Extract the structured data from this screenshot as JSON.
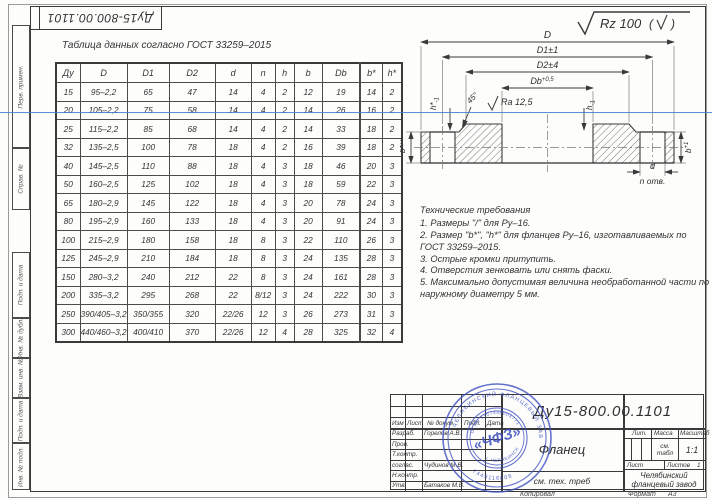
{
  "frame": {
    "margin_labels": [
      "Перв. примен.",
      "Справ. №",
      "Подп. и дата",
      "Инв. № дубл.",
      "Взам. инв. №",
      "Подп. и дата",
      "Инв. № подл."
    ],
    "corner_doc_number": "Ду15-800.00.1101"
  },
  "table": {
    "caption": "Таблица данных согласно ГОСТ  33259–2015",
    "headers": [
      "Ду",
      "D",
      "D1",
      "D2",
      "d",
      "n",
      "h",
      "b",
      "Db",
      "b*",
      "h*"
    ],
    "rows": [
      [
        "15",
        "95–2,2",
        "65",
        "47",
        "14",
        "4",
        "2",
        "12",
        "19",
        "14",
        "2"
      ],
      [
        "20",
        "105–2,2",
        "75",
        "58",
        "14",
        "4",
        "2",
        "14",
        "26",
        "16",
        "2"
      ],
      [
        "25",
        "115–2,2",
        "85",
        "68",
        "14",
        "4",
        "2",
        "14",
        "33",
        "18",
        "2"
      ],
      [
        "32",
        "135–2,5",
        "100",
        "78",
        "18",
        "4",
        "2",
        "16",
        "39",
        "18",
        "2"
      ],
      [
        "40",
        "145–2,5",
        "110",
        "88",
        "18",
        "4",
        "3",
        "18",
        "46",
        "20",
        "3"
      ],
      [
        "50",
        "160–2,5",
        "125",
        "102",
        "18",
        "4",
        "3",
        "18",
        "59",
        "22",
        "3"
      ],
      [
        "65",
        "180–2,9",
        "145",
        "122",
        "18",
        "4",
        "3",
        "20",
        "78",
        "24",
        "3"
      ],
      [
        "80",
        "195–2,9",
        "160",
        "133",
        "18",
        "4",
        "3",
        "20",
        "91",
        "24",
        "3"
      ],
      [
        "100",
        "215–2,9",
        "180",
        "158",
        "18",
        "8",
        "3",
        "22",
        "110",
        "26",
        "3"
      ],
      [
        "125",
        "245–2,9",
        "210",
        "184",
        "18",
        "8",
        "3",
        "24",
        "135",
        "28",
        "3"
      ],
      [
        "150",
        "280–3,2",
        "240",
        "212",
        "22",
        "8",
        "3",
        "24",
        "161",
        "28",
        "3"
      ],
      [
        "200",
        "335–3,2",
        "295",
        "268",
        "22",
        "8/12",
        "3",
        "24",
        "222",
        "30",
        "3"
      ],
      [
        "250",
        "390/405–3,2",
        "350/355",
        "320",
        "22/26",
        "12",
        "3",
        "26",
        "273",
        "31",
        "3"
      ],
      [
        "300",
        "440/460–3,2",
        "400/410",
        "370",
        "22/26",
        "12",
        "4",
        "28",
        "325",
        "32",
        "4"
      ]
    ]
  },
  "drawing": {
    "roughness_general": "Rz 100",
    "dims": {
      "D": "D",
      "D1": "D1±1",
      "D2": "D2±4",
      "Db": "Db",
      "Db_tol": "+0,5",
      "Ra": "Ra 12,5",
      "chamfer": "45°",
      "h_star": "h*",
      "h": "h",
      "b_star": "b*",
      "b": "b",
      "tol_minus1": "-1",
      "tol_plus1": "+1",
      "d_hole": "d",
      "n_holes": "n отв."
    }
  },
  "tech_requirements": {
    "title": "Технические требования",
    "items": [
      "1. Размеры \"/\" для Ру–16.",
      "2. Размер \"b*\", \"h*\" для фланцев Ру–16, изготавливаемых по ГОСТ 33259–2015.",
      "3. Острые кромки притупить.",
      "4. Отверстия зенковать или снять фаски.",
      "5. Максимально допустимая величина необработанной части по наружному диаметру 5 мм."
    ]
  },
  "title_block": {
    "doc_number": "Ду15-800.00.1101",
    "part_name": "Фланец",
    "material": "см. тех. треб",
    "company": "Челябинский фланцевый завод",
    "header_cells": [
      "Изм",
      "Лист",
      "№ докум.",
      "Подп.",
      "Дата"
    ],
    "sign_rows": [
      {
        "role": "Разраб.",
        "name": "Горелов А.В."
      },
      {
        "role": "Пров.",
        "name": ""
      },
      {
        "role": "Т.контр.",
        "name": ""
      },
      {
        "role": "соглас.",
        "name": "Чудинов М.В."
      },
      {
        "role": "Н.контр.",
        "name": ""
      },
      {
        "role": "Утв.",
        "name": "Батаков М.В."
      }
    ],
    "lit_label": "Лит.",
    "mass_label": "Масса",
    "scale_label": "Масштаб",
    "mass_value": "см. табл",
    "scale_value": "1:1",
    "sheet_label": "Лист",
    "sheets_label": "Листов",
    "sheets_value": "1",
    "footer_copy": "Копировал",
    "footer_format": "Формат",
    "footer_format_value": "А3"
  },
  "stamp": {
    "ring_top": "ЧЕЛЯБИНСКИЙ ФЛАНЦЕВЫЙ ЗАВОД",
    "ring_bottom": "7449116808",
    "inner_top": "ОГРН 1157448004771",
    "inner_bottom": "г. ЧЕЛЯБИНСК",
    "center": "«ЧФЗ»",
    "color": "#3f51c1"
  },
  "colors": {
    "line": "#3a3a3a",
    "artifact_blue": "#3c7dd2"
  }
}
